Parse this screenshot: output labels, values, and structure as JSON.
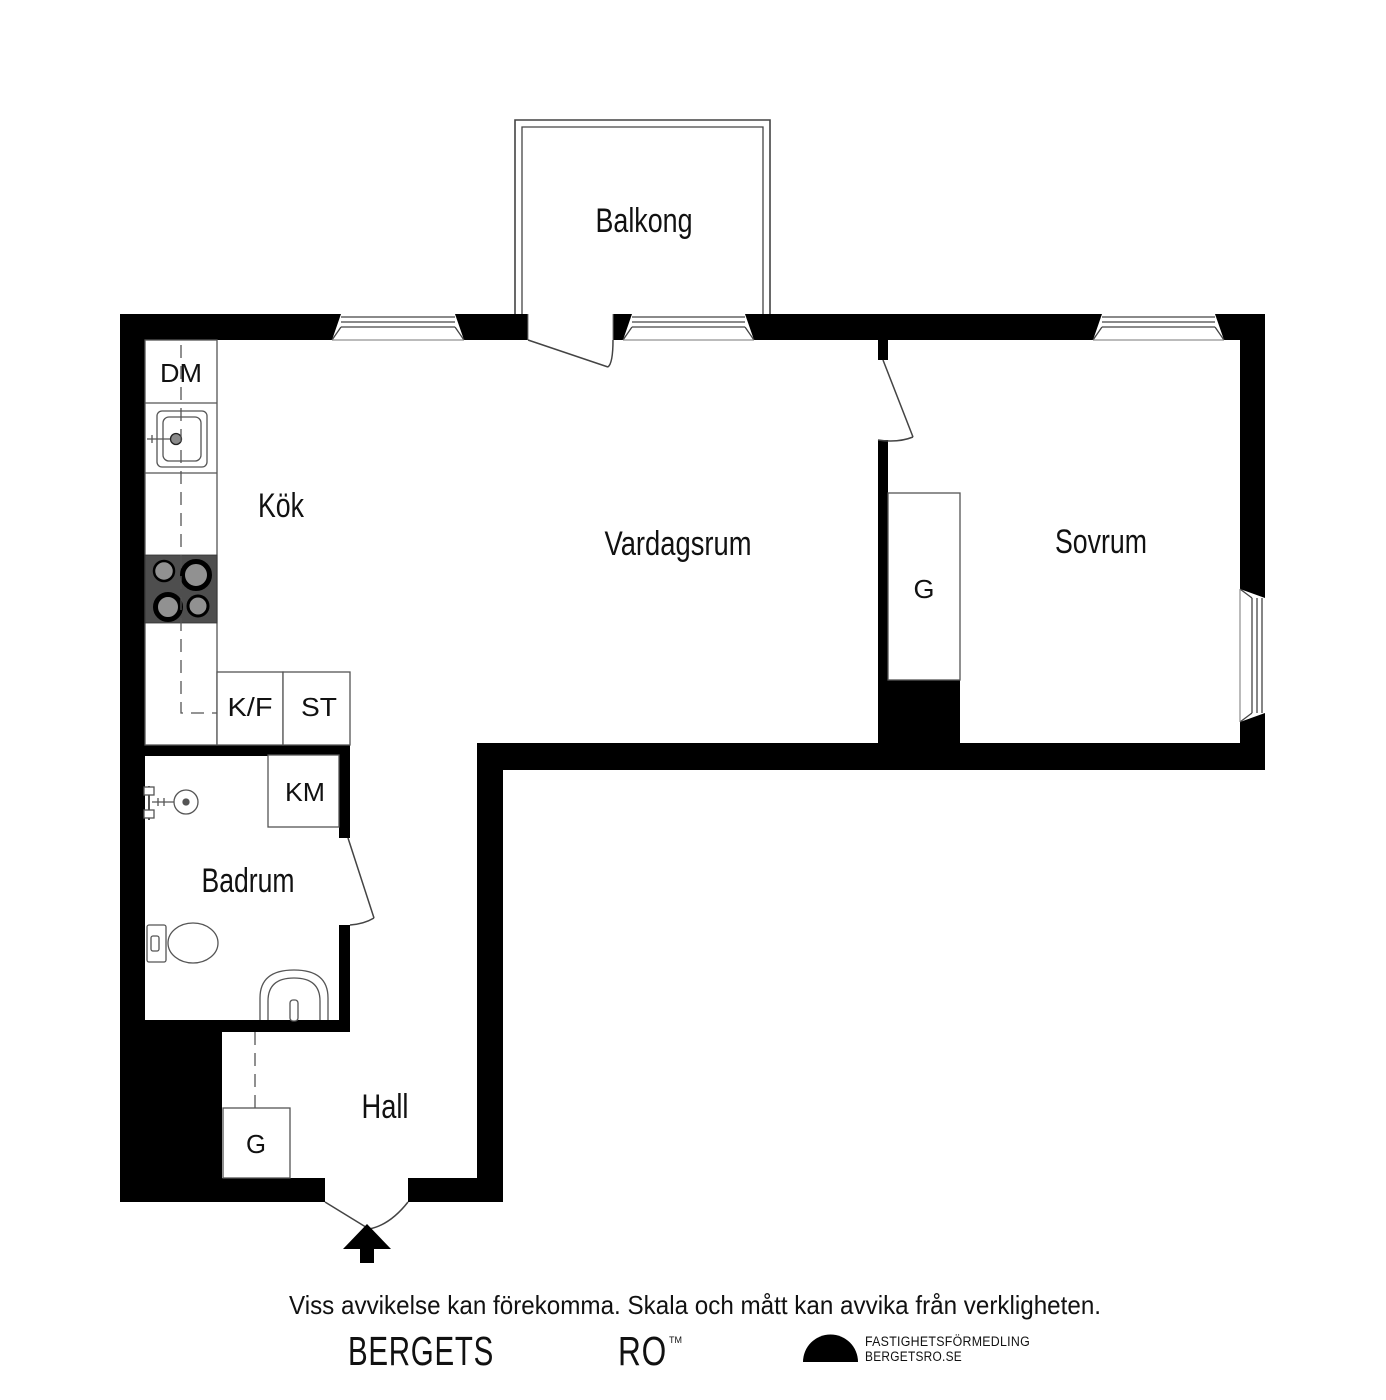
{
  "title": "Apartment floor plan",
  "rooms": {
    "balkong": "Balkong",
    "kok": "Kök",
    "vardagsrum": "Vardagsrum",
    "sovrum": "Sovrum",
    "badrum": "Badrum",
    "hall": "Hall"
  },
  "fixtures": {
    "dm": "DM",
    "kf": "K/F",
    "st": "ST",
    "km": "KM",
    "g_sovrum": "G",
    "g_hall": "G"
  },
  "footer": {
    "disclaimer": "Viss avvikelse kan förekomma. Skala och mått kan avvika från verkligheten.",
    "brand_name_left": "BERGETS",
    "brand_name_right": "RO",
    "trademark": "TM",
    "agency_line1": "FASTIGHETSFÖRMEDLING",
    "agency_line2": "BERGETSRO.SE"
  },
  "colors": {
    "wall": "#000000",
    "background": "#ffffff",
    "stove_top": "#4e4e4e",
    "burner": "#919191",
    "fixture_line": "#444444"
  }
}
